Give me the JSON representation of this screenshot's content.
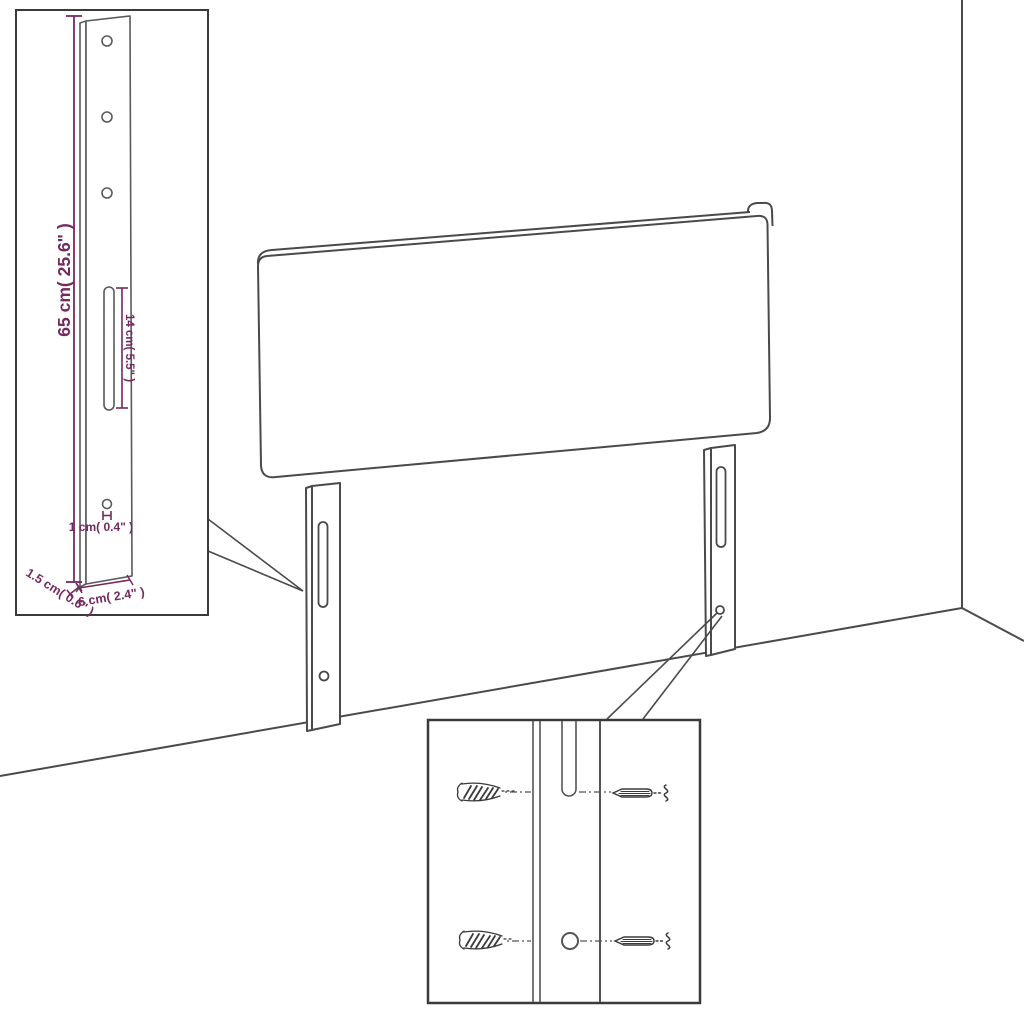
{
  "figure": {
    "type": "product-dimension-diagram",
    "subject": "upholstered headboard with two adjustable mounting legs shown in a room corner",
    "colors": {
      "line_art": "#4a4a4a",
      "inset_border": "#3a3a3a",
      "dimension": "#75295f",
      "background": "#ffffff"
    },
    "insets": {
      "leg_detail": {
        "description": "enlarged view of one mounting leg",
        "dimensions": {
          "leg_height": "65 cm( 25.6\" )",
          "slot_length": "14 cm( 5.5\" )",
          "hole_diameter": "1 cm( 0.4\" )",
          "leg_depth": "1.5 cm( 0.6\" )",
          "leg_width": "6 cm( 2.4\" )"
        }
      },
      "mounting_detail": {
        "description": "close-up of leg slot and hole with wall plugs and screws",
        "icons": [
          "wall-plug-icon",
          "screw-icon",
          "screw-thread-icon"
        ]
      }
    }
  }
}
